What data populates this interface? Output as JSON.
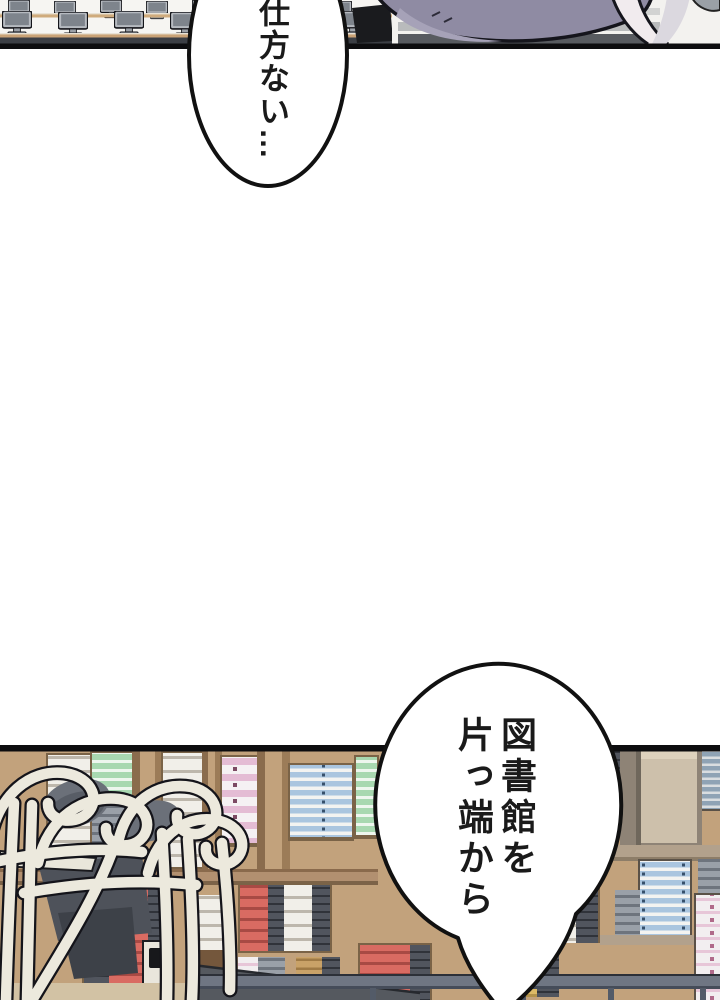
{
  "page": {
    "kind": "manga page",
    "width": 720,
    "height": 1000
  },
  "speech_bubbles": [
    {
      "id": "bubble-1",
      "text": "仕方ない…",
      "writing_direction": "vertical-rl",
      "shape": "ellipse",
      "location": "top"
    },
    {
      "id": "bubble-2",
      "lines": [
        "図書館を",
        "片っ端から"
      ],
      "writing_direction": "vertical-rl",
      "shape": "circle-with-tail",
      "location": "bottom"
    }
  ],
  "panels": [
    {
      "id": "panel-1",
      "scene": "computer classroom with rows of desks and monitors, purple-haired figure at right",
      "location": "top strip"
    },
    {
      "id": "panel-2",
      "scene": "library with tall bookshelves full of books and upside-down chairs stacked on tables",
      "location": "bottom"
    }
  ],
  "palette": {
    "ink": "#111111",
    "bubble_fill": "#ffffff",
    "purple_hair": "#8f8ba3",
    "purple_light": "#a6a2b8",
    "strap_white": "#f1ebee",
    "wood_base": "#c2a27c",
    "wood_plank": "#b29070",
    "beige_panel": "#cdc0ab",
    "rail_gray": "#6f7683",
    "counter_dark": "#55595f",
    "chair_tube": "#ece9dd",
    "chair_seat": "#6b7079",
    "book_red": "#d96b62",
    "book_blue": "#aac5df",
    "book_green": "#a8d8b0",
    "book_pink": "#e4bcd4",
    "desk_wood": "#cfab7d",
    "monitor_gray": "#b6bac0"
  }
}
